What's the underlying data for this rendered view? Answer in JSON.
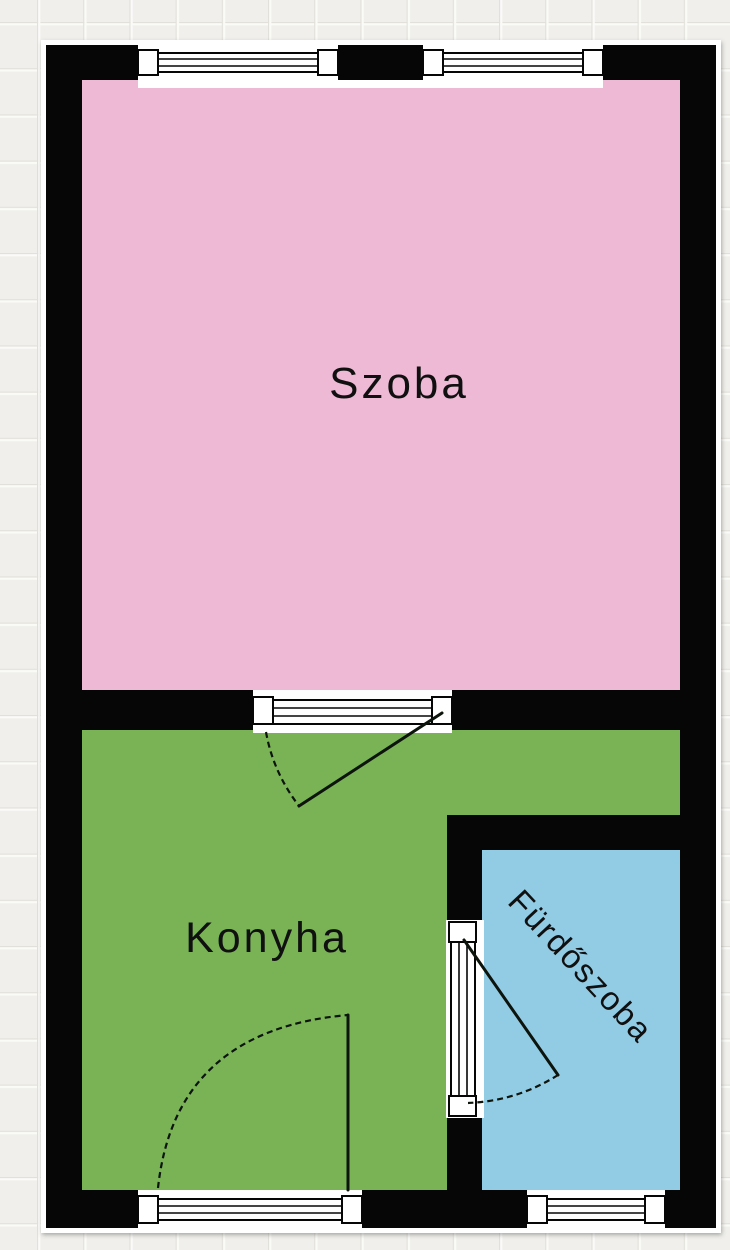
{
  "floorplan": {
    "canvas": {
      "width": 730,
      "height": 1250
    },
    "background": {
      "base_color": "#f0efeb",
      "grid_highlight_color": "#fafaf7",
      "grid_shadow_color": "#e2e0da",
      "grid_size_px": 46.2
    },
    "wall_color": "#060606",
    "outline_color": "#ffffff",
    "opening_frame_color": "#ffffff",
    "rooms": [
      {
        "id": "szoba",
        "label": "Szoba",
        "fill": "#edb9d4",
        "label_color": "#101010",
        "label_rotation_deg": 0
      },
      {
        "id": "konyha",
        "label": "Konyha",
        "fill": "#79b356",
        "label_color": "#101010",
        "label_rotation_deg": 0
      },
      {
        "id": "furdoszoba",
        "label": "Fürdőszoba",
        "fill": "#92cbe4",
        "label_color": "#101010",
        "label_rotation_deg": 47
      }
    ],
    "openings": [
      {
        "id": "window-top-left",
        "type": "window",
        "wall": "north"
      },
      {
        "id": "window-top-right",
        "type": "window",
        "wall": "north"
      },
      {
        "id": "door-szoba-konyha",
        "type": "door",
        "between": "Szoba-Konyha"
      },
      {
        "id": "door-konyha-furdoszoba",
        "type": "door",
        "between": "Konyha-Fürdőszoba"
      },
      {
        "id": "door-konyha-south",
        "type": "door",
        "wall": "south"
      },
      {
        "id": "window-furdoszoba",
        "type": "window",
        "wall": "south"
      }
    ]
  }
}
